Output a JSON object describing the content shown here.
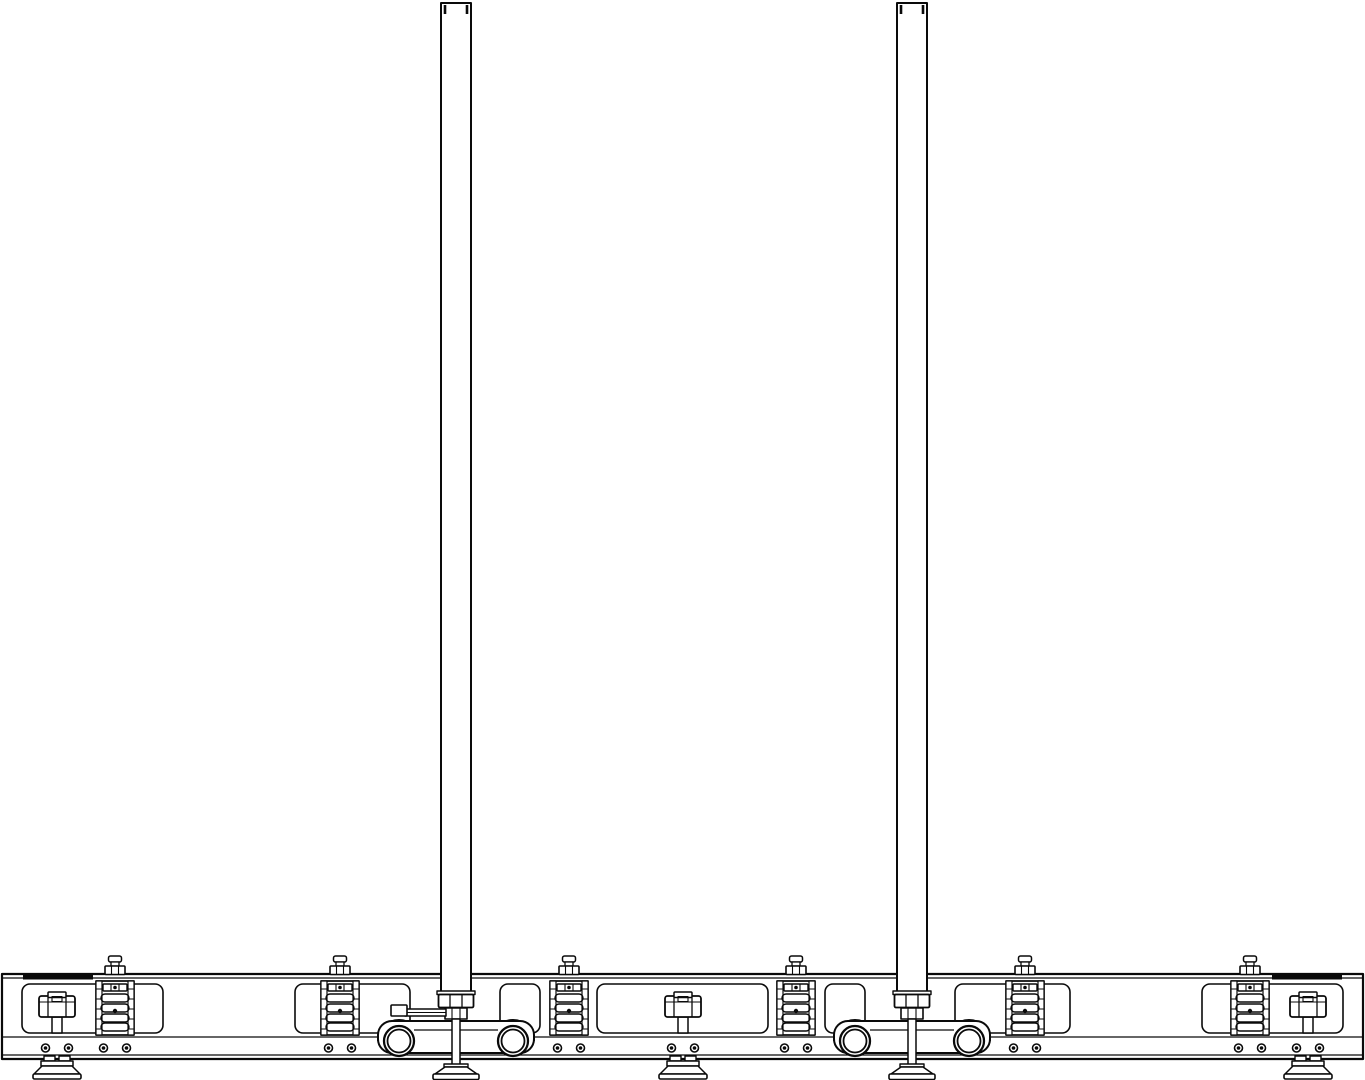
{
  "drawing": {
    "type": "cad-line-drawing",
    "subject": "dual vertical-post stand base assembly, front elevation",
    "canvas": {
      "width": 1365,
      "height": 1080
    },
    "colors": {
      "background": "#ffffff",
      "line": "#0a0a0a"
    },
    "beam": {
      "x": 2,
      "y": 974,
      "width": 1361,
      "height": 85,
      "inner_top_y": 978,
      "mid_line_y": 1037,
      "inner_bottom_y": 1055,
      "end_plate_y": 975,
      "end_plate_height": 4.5,
      "end_plates": [
        {
          "x": 23,
          "width": 70
        },
        {
          "x": 1272,
          "width": 70
        }
      ]
    },
    "windows": {
      "y": 984,
      "height": 49,
      "corner_radius": 8,
      "items": [
        {
          "x": 22,
          "width": 141
        },
        {
          "x": 295,
          "width": 115
        },
        {
          "x": 500,
          "width": 40
        },
        {
          "x": 597,
          "width": 171
        },
        {
          "x": 825,
          "width": 40
        },
        {
          "x": 955,
          "width": 115
        },
        {
          "x": 1202,
          "width": 141
        }
      ]
    },
    "poles": {
      "width": 30,
      "top_y": 3,
      "bottom_y": 993,
      "items": [
        {
          "id": "left",
          "cx": 456,
          "has_lever": true
        },
        {
          "id": "right",
          "cx": 912,
          "has_lever": false
        }
      ]
    },
    "spring_stacks": {
      "box_y": 981,
      "box_height": 54,
      "box_width": 38,
      "centers": [
        115,
        340,
        569,
        796,
        1025,
        1250
      ]
    },
    "hand_knobs": {
      "body_y": 996,
      "body_width": 36,
      "body_height": 21,
      "centers": [
        57,
        683,
        1308
      ]
    },
    "bolt_hole_pairs": {
      "y": 1048,
      "offset": 11.5,
      "radius": 4,
      "centers": [
        57,
        115,
        340,
        569,
        683,
        796,
        1025,
        1250,
        1308
      ]
    },
    "roller_carriages": {
      "wheel_offset": 57,
      "wheel_radius": 15,
      "wheel_cy": 1041,
      "plate_y": 1021,
      "plate_height": 32,
      "plate_half_width": 78,
      "items": [
        {
          "id": "left",
          "cx": 456
        },
        {
          "id": "right",
          "cx": 912
        }
      ]
    },
    "lever": {
      "tip_x": 391,
      "tip_y": 1005,
      "tip_w": 16,
      "tip_h": 11,
      "bar_x": 405,
      "bar_y": 1009,
      "bar_w": 41,
      "bar_h": 7
    },
    "feet": [
      {
        "cx": 57,
        "style": "pad",
        "id": "left-knob-foot"
      },
      {
        "cx": 456,
        "style": "cone",
        "id": "left-post-foot"
      },
      {
        "cx": 683,
        "style": "pad",
        "id": "center-knob-foot"
      },
      {
        "cx": 912,
        "style": "cone",
        "id": "right-post-foot"
      },
      {
        "cx": 1308,
        "style": "pad",
        "id": "right-knob-foot"
      }
    ]
  }
}
